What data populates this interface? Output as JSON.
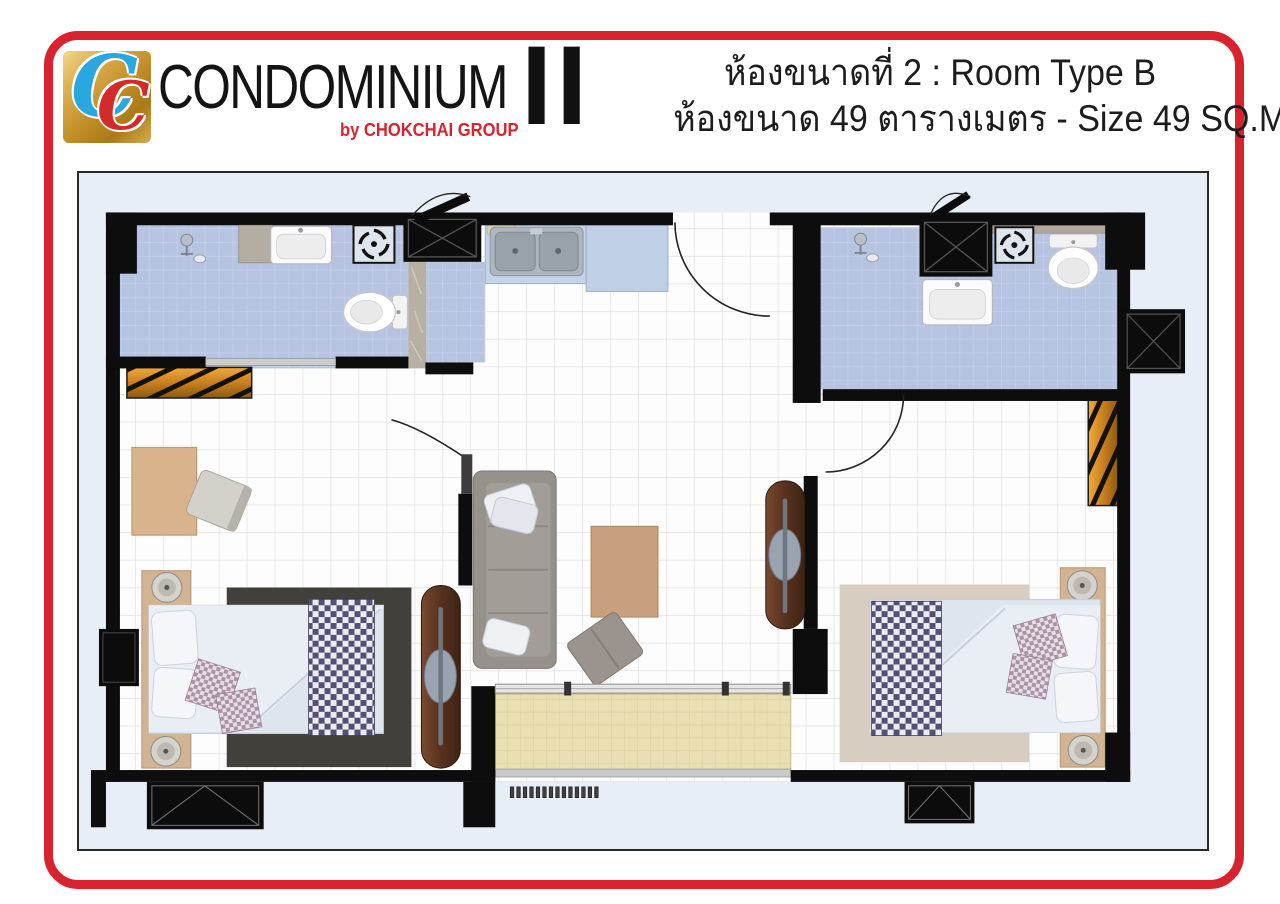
{
  "header": {
    "logo": {
      "monogram_c1": "C",
      "monogram_c2": "C",
      "brand": "CONDOMINIUM",
      "byline": "by CHOKCHAI GROUP",
      "numeral": "II"
    },
    "title_line1": "ห้องขนาดที่ 2 : Room Type B",
    "title_line2": "ห้องขนาด 49 ตารางเมตร - Size 49 SQ.M."
  },
  "room_info": {
    "room_type": "Room Type B",
    "room_number": "2",
    "size_sqm": "49"
  },
  "colors": {
    "frame_red": "#d8232e",
    "byline_red": "#d8232e",
    "logo_gold": "#c08c24",
    "logo_blue_c": "#29a8e0",
    "logo_red_c": "#d22b2b",
    "wall_black": "#0d0d0d",
    "outside_blue": "#e7eef6",
    "floor_tile_white": "#fdfdfd",
    "bathroom_blue": "#b6c4e2",
    "kitchen_counter_blue": "#c2d3e8",
    "balcony_tan": "#eadfb2",
    "wardrobe_amber": "#d9912c",
    "rug_dark": "#41403a",
    "rug_light": "#d7cec1",
    "bed_linen": "#dfe5ed",
    "headboard_wood": "#d3b492",
    "desk_wood": "#d9b38c",
    "sofa_grey": "#97918b",
    "coffee_table_wood": "#c8a07e",
    "sliding_door_brown": "#61381f",
    "runner_check": "#515174"
  },
  "plan": {
    "rooms": [
      "bedroom-left",
      "bathroom-left",
      "kitchen",
      "living-room",
      "foyer",
      "bathroom-right",
      "bedroom-right",
      "balcony"
    ],
    "fixtures": [
      "toilet",
      "wash-basin",
      "double-kitchen-sink",
      "ventilation-fan",
      "shower-head",
      "sliding-glass-door",
      "swing-door",
      "window",
      "ac-ledge"
    ],
    "furniture": [
      "double-bed",
      "bedside-lamp",
      "checkered-bed-runner",
      "cushions",
      "rug",
      "desk",
      "chair",
      "sofa",
      "coffee-table",
      "ottoman",
      "wardrobe",
      "sliding-door-panel"
    ]
  }
}
